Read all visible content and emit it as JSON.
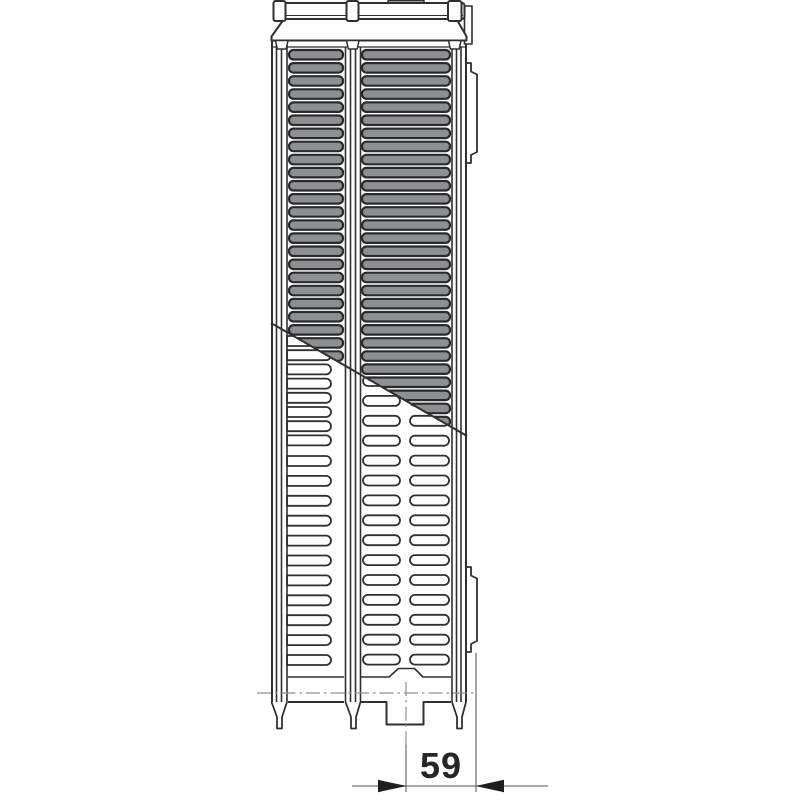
{
  "page": {
    "background": "#ffffff"
  },
  "diagram": {
    "name": "panel-radiator-side-profile-technical-drawing",
    "dimension": {
      "value": "59"
    },
    "colors": {
      "line": "#2e3131",
      "slot_fill": "#8b9191",
      "slot_stroke": "#272b2b",
      "centerline": "#8f8f8f",
      "dimension_line": "#757575",
      "arrow": "#1e1e1e",
      "label_text": "#262626",
      "background": "#ffffff"
    },
    "grille": {
      "top": 50,
      "pitch": 13.1,
      "rows": 30,
      "slot_height": 9.5,
      "corner_radius": 4.5,
      "columns": [
        {
          "x": 289,
          "width": 54
        },
        {
          "x": 362,
          "width": 88
        }
      ]
    },
    "fins": {
      "slot_height": 10,
      "left_column": {
        "x": 287,
        "width": 44,
        "attached_left": true,
        "bands": [
          {
            "start": 336,
            "pitch": 14.2,
            "count": 8
          },
          {
            "start": 456,
            "pitch": 19.9,
            "count": 11
          }
        ]
      },
      "slot_columns": [
        {
          "x": 363,
          "width": 37
        },
        {
          "x": 410,
          "width": 39
        }
      ],
      "rows": {
        "start": 376,
        "pitch": 19.9,
        "count": 15
      }
    },
    "cutaway_line": {
      "x1": 271,
      "y1": 323,
      "x2": 467,
      "y2": 436
    }
  }
}
